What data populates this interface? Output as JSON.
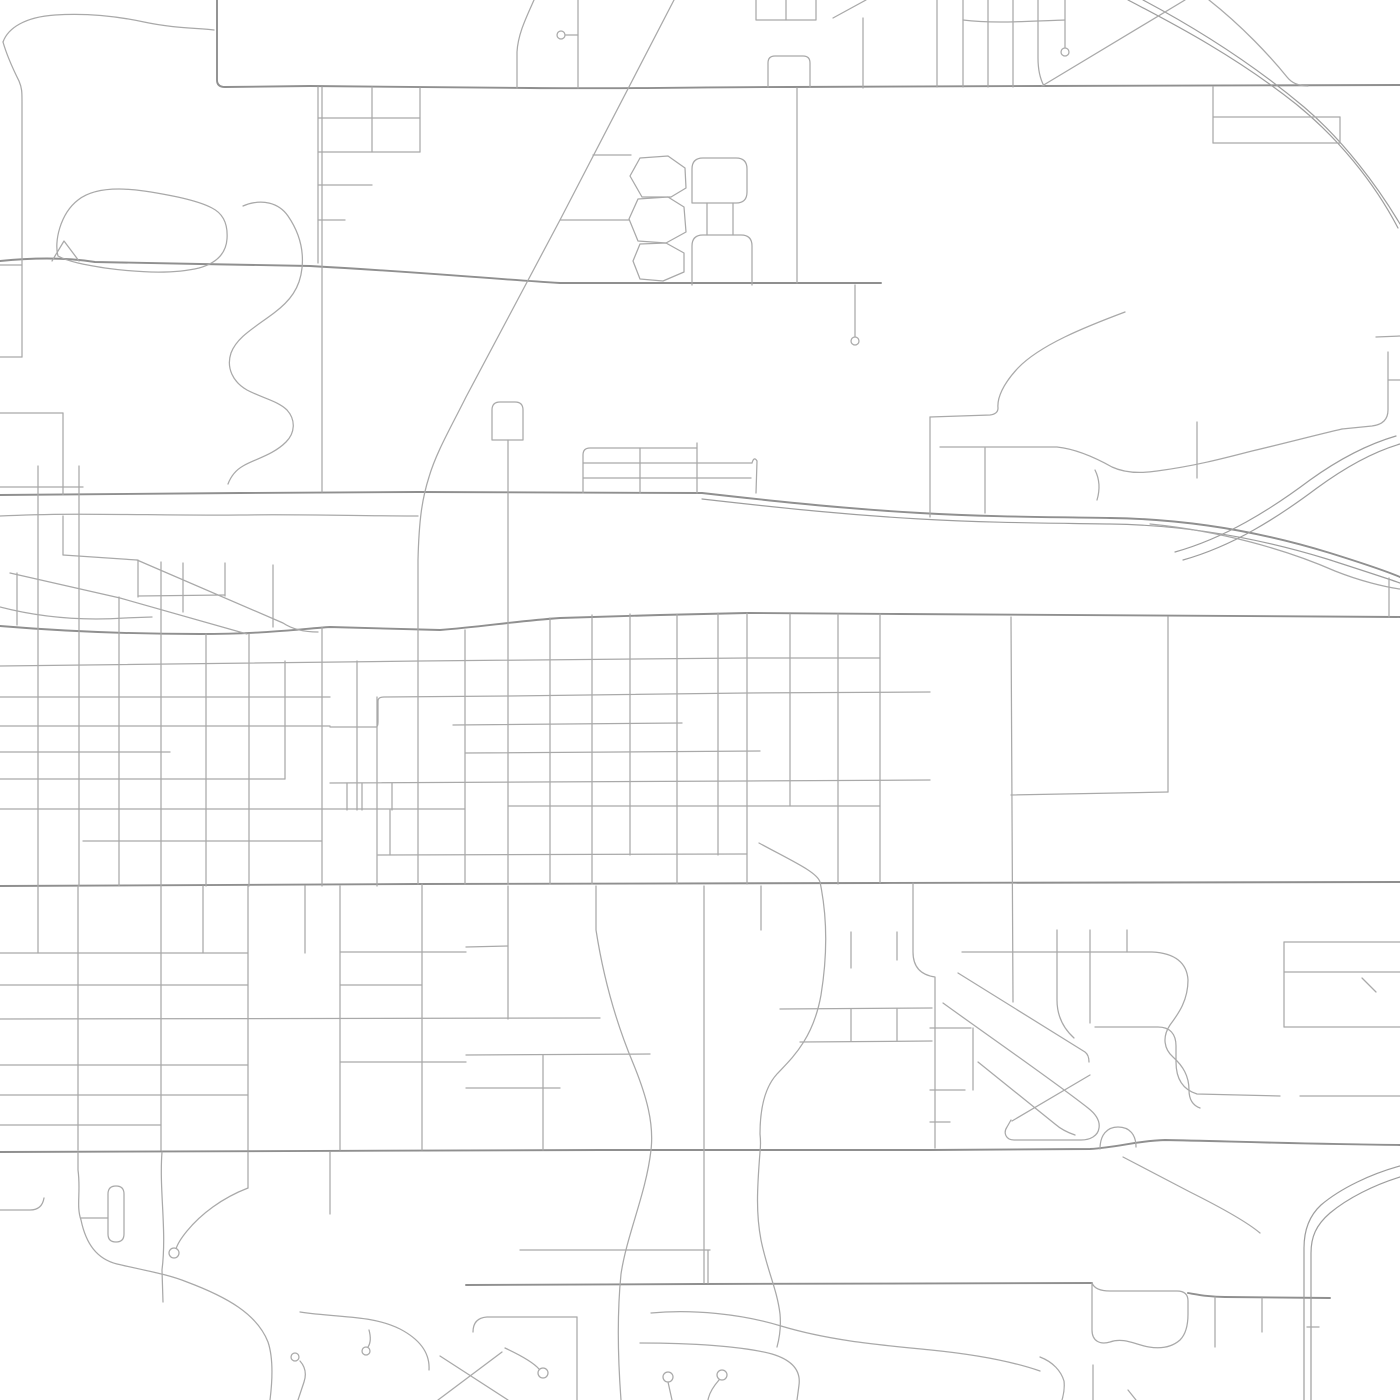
{
  "map": {
    "kind": "street-map",
    "width": 1400,
    "height": 1400,
    "background": "#ffffff",
    "colors": {
      "arterial": "#8f8f8f",
      "street": "#a9a9a9",
      "railway": "#9e9e9e"
    },
    "layers": [
      {
        "id": "arterial-roads",
        "stroke": "#8f8f8f",
        "stroke_width": 1.9,
        "paths": [
          "M217,0 L217,80 Q217,87 225,87 L310,86 L530,88 C620,89 700,87 790,87 L1042,86 L1400,85",
          "M0,261 C40,257 70,258 95,262 L200,264 L310,266 C420,272 480,278 560,283 L881,283",
          "M0,495 C80,494 160,493 240,493 L418,492 L702,493",
          "M702,493 C790,503 850,509 920,513 C990,517 1050,517 1110,518 C1190,519 1265,533 1330,553 C1362,563 1386,571 1400,577",
          "M0,626 C60,631 120,634 200,634 C265,634 300,629 330,627 L440,630 C480,627 517,621 560,618 L660,615 L747,613 L900,614 L1400,617",
          "M0,886 L418,884 L880,883 L1400,882",
          "M0,1152 L600,1150 L930,1150 L1090,1149 C1120,1147 1135,1141 1165,1140 C1220,1141 1300,1144 1400,1145",
          "M466,1285 L700,1284 L1092,1283",
          "M1188,1293 C1200,1295 1210,1297 1225,1297 L1330,1298"
        ]
      },
      {
        "id": "railways",
        "stroke": "#9e9e9e",
        "stroke_width": 1.2,
        "paths": [
          "M702,499 C790,509 850,515 920,519 C990,523 1050,523 1110,524 C1188,525 1262,539 1327,559 C1358,569 1383,577 1400,583",
          "M1128,0 C1178,26 1238,58 1296,104 C1338,138 1374,182 1398,228",
          "M1143,0 C1190,25 1248,60 1304,107 C1344,141 1378,187 1400,224",
          "M1175,552 C1225,538 1270,510 1310,480 C1342,457 1372,443 1396,436",
          "M1183,560 C1233,546 1277,518 1317,488 C1347,466 1376,451 1400,444",
          "M1400,1166 C1371,1174 1341,1188 1321,1205 C1309,1216 1304,1230 1304,1248 L1304,1400",
          "M1400,1177 C1374,1185 1348,1198 1330,1213 C1316,1225 1311,1237 1311,1253 L1311,1400"
        ]
      },
      {
        "id": "streets",
        "stroke": "#a9a9a9",
        "stroke_width": 1.25,
        "paths": [
          "M3,42 C8,28 25,17 55,15 C85,13 116,16 144,22 C172,28 196,28 214,30",
          "M3,42 C7,56 13,69 19,81 C22,88 22,92 22,102 L22,357",
          "M0,265 L22,265",
          "M0,357 L22,357",
          "M58,256 C54,242 60,214 78,200 C92,189 116,187 144,191 C171,195 197,200 212,208 C224,214 228,225 227,239 C226,253 217,263 199,268 C170,275 134,272 105,268 C86,265 69,262 58,256",
          "M52,261 L64,241 L79,261",
          "M243,206 C262,198 279,203 288,216 C299,232 304,249 302,268 C300,288 290,301 274,313 C254,328 237,337 231,353 C226,368 233,382 247,390 C262,398 278,401 287,410 C296,420 295,433 286,442 C273,455 255,459 243,466 C236,470 231,476 228,484",
          "M318,87 L318,263",
          "M318,118 L420,118",
          "M372,87 L372,152",
          "M318,152 L420,152",
          "M420,88 L420,152",
          "M318,185 L372,185",
          "M318,220 L345,220",
          "M578,0 L578,88",
          "M561,35 L578,35",
          "M534,0 C526,18 518,34 517,52 L517,88",
          "M756,0 L756,20 L816,20 L816,0",
          "M786,0 L786,20",
          "M833,18 L866,0",
          "M863,18 L863,88",
          "M768,87 L768,63 Q768,56 775,56 L803,56 Q810,56 810,63 L810,87",
          "M674,0 L560,220 L466,397 C450,429 436,453 429,477 C422,499 419,520 418,560 L418,884",
          "M593,155 L631,155",
          "M560,220 L629,220",
          "M630,176 L640,158 L668,156 L685,168 L686,188 L671,197 L642,197 Z",
          "M629,219 L638,199 L668,197 L684,207 L686,232 L666,243 L638,241 Z",
          "M633,261 L640,244 L666,243 L684,253 L684,272 L663,281 L640,279 Z",
          "M692,203 L692,169 Q692,158 703,158 L736,158 Q747,158 747,169 L747,192 Q747,203 736,203 Z",
          "M707,203 L707,235",
          "M733,203 L733,235",
          "M692,285 L692,246 Q692,235 703,235 L741,235 Q752,235 752,246 L752,285",
          "M797,88 L797,283",
          "M855,285 L855,337",
          "M937,0 L937,87",
          "M963,0 L963,87",
          "M988,0 L988,87",
          "M1013,0 L1013,87",
          "M1038,0 L1038,58 Q1038,75 1044,86",
          "M963,20 C995,24 1030,21 1065,20",
          "M1065,0 L1065,48",
          "M1185,0 L1042,86",
          "M1209,0 C1242,26 1270,56 1287,77 Q1294,86 1308,86",
          "M1213,87 L1213,143",
          "M1213,117 L1340,117",
          "M1213,143 L1340,143",
          "M1340,117 L1340,143",
          "M0,413 L63,413",
          "M63,413 L63,495",
          "M492,440 L492,410 Q492,402 500,402 L515,402 Q523,402 523,410 L523,440 Z",
          "M508,440 L508,493",
          "M930,417 L930,517",
          "M1125,312 C1085,327 1040,345 1018,368 C1003,384 997,398 998,408 Q998,414 990,415 L930,417",
          "M985,448 L985,513",
          "M940,447 L1057,447 C1076,449 1096,458 1112,467 C1127,474 1144,473 1157,471 C1195,466 1225,458 1252,451 C1282,444 1316,435 1342,429",
          "M1197,422 L1197,478",
          "M1388,352 L1388,410 Q1388,424 1372,426 L1342,429",
          "M1376,337 L1400,336",
          "M1388,380 L1400,380",
          "M1095,470 C1100,480 1100,490 1097,500",
          "M583,493 L583,455 Q583,448 590,448 L697,448",
          "M583,463 L752,463",
          "M583,478 L751,478",
          "M640,448 L640,493",
          "M697,443 L697,493",
          "M752,463 Q754,456 757,461 L756,493",
          "M0,487 L83,487",
          "M0,516 C80,512 160,516 240,515 C300,514 360,516 418,516",
          "M38,466 L38,886",
          "M79,466 L79,886",
          "M63,516 L63,555",
          "M63,555 L137,560",
          "M10,573 L120,598 L247,634",
          "M137,560 L283,623 C292,629 304,632 318,632",
          "M0,607 C50,620 95,620 125,618 L152,617",
          "M17,573 L17,625",
          "M119,597 L119,634",
          "M138,560 L138,597",
          "M161,562 L161,613",
          "M183,563 L183,612",
          "M225,563 L225,596",
          "M138,596 L225,595",
          "M273,565 L273,627",
          "M322,87 L322,492",
          "M119,634 L119,886",
          "M161,613 L161,886",
          "M206,634 L206,886",
          "M249,634 L249,886",
          "M285,661 L285,779",
          "M322,627 L322,886",
          "M357,661 L357,810",
          "M377,697 L377,886",
          "M392,783 L392,810",
          "M465,630 L465,884",
          "M508,493 L508,884",
          "M550,618 L550,884",
          "M592,615 L592,884",
          "M630,614 L630,855",
          "M677,614 L677,884",
          "M718,613 L718,855",
          "M747,613 L747,884",
          "M790,614 L790,806",
          "M838,614 L838,884",
          "M880,614 L880,883",
          "M0,666 C150,663 300,662 420,661 C550,660 650,659 747,658 L880,658",
          "M330,727 L376,727 Q378,727 378,722 L378,701 Q378,697 384,697 L510,696 L747,693 L930,692",
          "M0,697 L330,697",
          "M0,726 L330,726",
          "M453,725 L682,723",
          "M0,752 L170,752",
          "M465,753 L760,751",
          "M0,779 L285,779",
          "M330,783 L747,781 L930,780",
          "M0,809 L465,809",
          "M508,806 L880,806",
          "M83,841 L322,841",
          "M378,855 L747,854",
          "M347,783 L347,810",
          "M362,783 L362,810",
          "M390,810 L390,855",
          "M1011,617 L1013,1002",
          "M1168,617 L1168,792",
          "M1011,795 L1168,792",
          "M1389,578 L1389,617",
          "M1150,524 C1220,531 1285,549 1335,571 C1360,581 1385,587 1400,589",
          "M962,952 L1152,952 C1175,953 1187,963 1188,980 C1188,1000 1179,1013 1170,1025 C1162,1037 1164,1049 1173,1057 C1183,1066 1189,1076 1189,1090 Q1189,1104 1200,1108",
          "M1127,930 L1127,952",
          "M1057,930 L1057,1000 C1057,1016 1063,1028 1074,1038",
          "M1090,930 L1090,1023",
          "M958,973 L1085,1052 Q1089,1055 1089,1062",
          "M943,1003 C990,1037 1055,1082 1088,1108 C1097,1115 1100,1122 1099,1128 C1098,1136 1090,1140 1081,1140 L1014,1140 C1006,1140 1003,1133 1007,1127 L1011,1120",
          "M978,1062 L1055,1124 Q1063,1131 1075,1135",
          "M1012,1121 L1090,1075",
          "M913,883 L913,952 C913,967 921,975 935,977 L935,1148",
          "M930,1028 L971,1028",
          "M930,1090 L965,1090",
          "M973,1028 L973,1090",
          "M930,1122 L950,1122",
          "M1100,1149 C1100,1135 1107,1127 1118,1127 C1130,1127 1136,1135 1136,1147",
          "M1123,1157 L1190,1192 C1222,1208 1247,1222 1260,1233",
          "M1095,1027 L1158,1027 C1170,1027 1176,1034 1176,1046 L1176,1062 C1176,1080 1184,1090 1197,1094 L1280,1096",
          "M1284,942 L1400,942",
          "M1284,972 L1400,972",
          "M1284,942 L1284,1027",
          "M1284,1027 L1400,1027",
          "M1300,1096 L1400,1096",
          "M1362,978 L1376,992",
          "M78,886 L78,1150",
          "M161,886 L161,1150",
          "M248,886 L248,1150",
          "M340,886 L340,1150",
          "M422,884 L422,1150",
          "M38,886 L38,953",
          "M203,886 L203,953",
          "M305,886 L305,953",
          "M0,953 L248,953",
          "M340,952 L466,952",
          "M0,985 L248,985",
          "M340,985 L422,985",
          "M0,1019 L600,1018",
          "M0,1065 L248,1065",
          "M340,1062 L466,1062",
          "M0,1095 L248,1095",
          "M0,1125 L161,1125",
          "M508,886 L508,1019",
          "M596,886 L596,930 C603,975 615,1020 633,1063 C647,1097 654,1124 651,1150 C646,1194 627,1234 621,1274 C617,1314 618,1360 621,1400",
          "M704,886 L704,1283",
          "M761,886 L761,930",
          "M759,843 C792,861 817,872 820,882 C828,920 827,958 821,995 C813,1040 791,1059 777,1074 C766,1086 760,1106 760,1134 Q761,1143 760,1152 C757,1190 756,1214 761,1240 C767,1270 777,1289 780,1314 C781,1325 780,1336 777,1347",
          "M466,947 L508,946",
          "M466,1055 L650,1054",
          "M466,1088 L560,1088",
          "M543,1055 L543,1150",
          "M780,1009 L932,1008",
          "M800,1042 L932,1041",
          "M851,1009 L851,1041",
          "M897,1009 L897,1041",
          "M851,932 L851,968",
          "M897,932 L897,960",
          "M78,1152 L78,1170 C81,1192 76,1206 81,1220 C86,1244 97,1259 117,1264 C147,1271 167,1274 187,1282 C227,1297 257,1314 268,1342 C274,1360 272,1384 270,1400",
          "M108,1234 L108,1194 Q108,1186 116,1186 Q124,1186 124,1194 L124,1234 Q124,1242 116,1242 Q108,1242 108,1234 Z",
          "M81,1218 L108,1218",
          "M0,1210 L30,1210 Q42,1210 44,1198",
          "M162,1152 C159,1190 167,1230 162,1270 L163,1302",
          "M248,1152 L248,1188",
          "M248,1188 C222,1198 201,1214 187,1231 Q178,1242 176,1249",
          "M330,1152 L330,1214",
          "M300,1312 C340,1318 372,1315 400,1329 C421,1340 430,1354 429,1370",
          "M369,1330 Q372,1341 368,1347",
          "M298,1400 L304,1382 Q308,1370 300,1361",
          "M440,1356 L508,1400",
          "M502,1352 L438,1400",
          "M473,1332 Q473,1318 487,1317 L577,1317",
          "M577,1317 L577,1400",
          "M505,1348 C520,1355 533,1362 539,1369",
          "M651,1313 C692,1309 742,1314 781,1326 C831,1341 881,1345 931,1350 C971,1354 1011,1361 1040,1371",
          "M640,1343 C690,1343 742,1346 772,1354 C792,1360 801,1370 799,1385 Q798,1393 797,1400",
          "M668,1382 L672,1400",
          "M719,1380 C712,1388 709,1394 708,1400",
          "M520,1250 L710,1250",
          "M708,1250 L708,1283",
          "M1092,1283 L1092,1330 C1092,1341 1100,1345 1110,1342 C1124,1337 1136,1345 1149,1347 C1161,1349 1172,1347 1180,1340 C1186,1334 1188,1325 1188,1314 L1188,1301 C1188,1294 1184,1291 1177,1291 L1110,1291 C1100,1291 1094,1288 1092,1283 Z",
          "M1215,1297 L1215,1347",
          "M1262,1298 L1262,1332",
          "M1307,1327 L1319,1327",
          "M1040,1357 C1053,1362 1061,1371 1064,1381 Q1065,1390 1062,1400",
          "M1093,1365 L1093,1400",
          "M1128,1390 L1136,1400"
        ]
      },
      {
        "id": "cul-de-sacs",
        "stroke": "#a9a9a9",
        "stroke_width": 1.25,
        "fill": "#ffffff",
        "circles": [
          {
            "cx": 561,
            "cy": 35,
            "r": 4
          },
          {
            "cx": 1065,
            "cy": 52,
            "r": 4
          },
          {
            "cx": 855,
            "cy": 341,
            "r": 4
          },
          {
            "cx": 174,
            "cy": 1253,
            "r": 5
          },
          {
            "cx": 543,
            "cy": 1373,
            "r": 5
          },
          {
            "cx": 668,
            "cy": 1377,
            "r": 5
          },
          {
            "cx": 722,
            "cy": 1375,
            "r": 5
          },
          {
            "cx": 366,
            "cy": 1351,
            "r": 4
          },
          {
            "cx": 295,
            "cy": 1357,
            "r": 4
          }
        ]
      }
    ]
  }
}
